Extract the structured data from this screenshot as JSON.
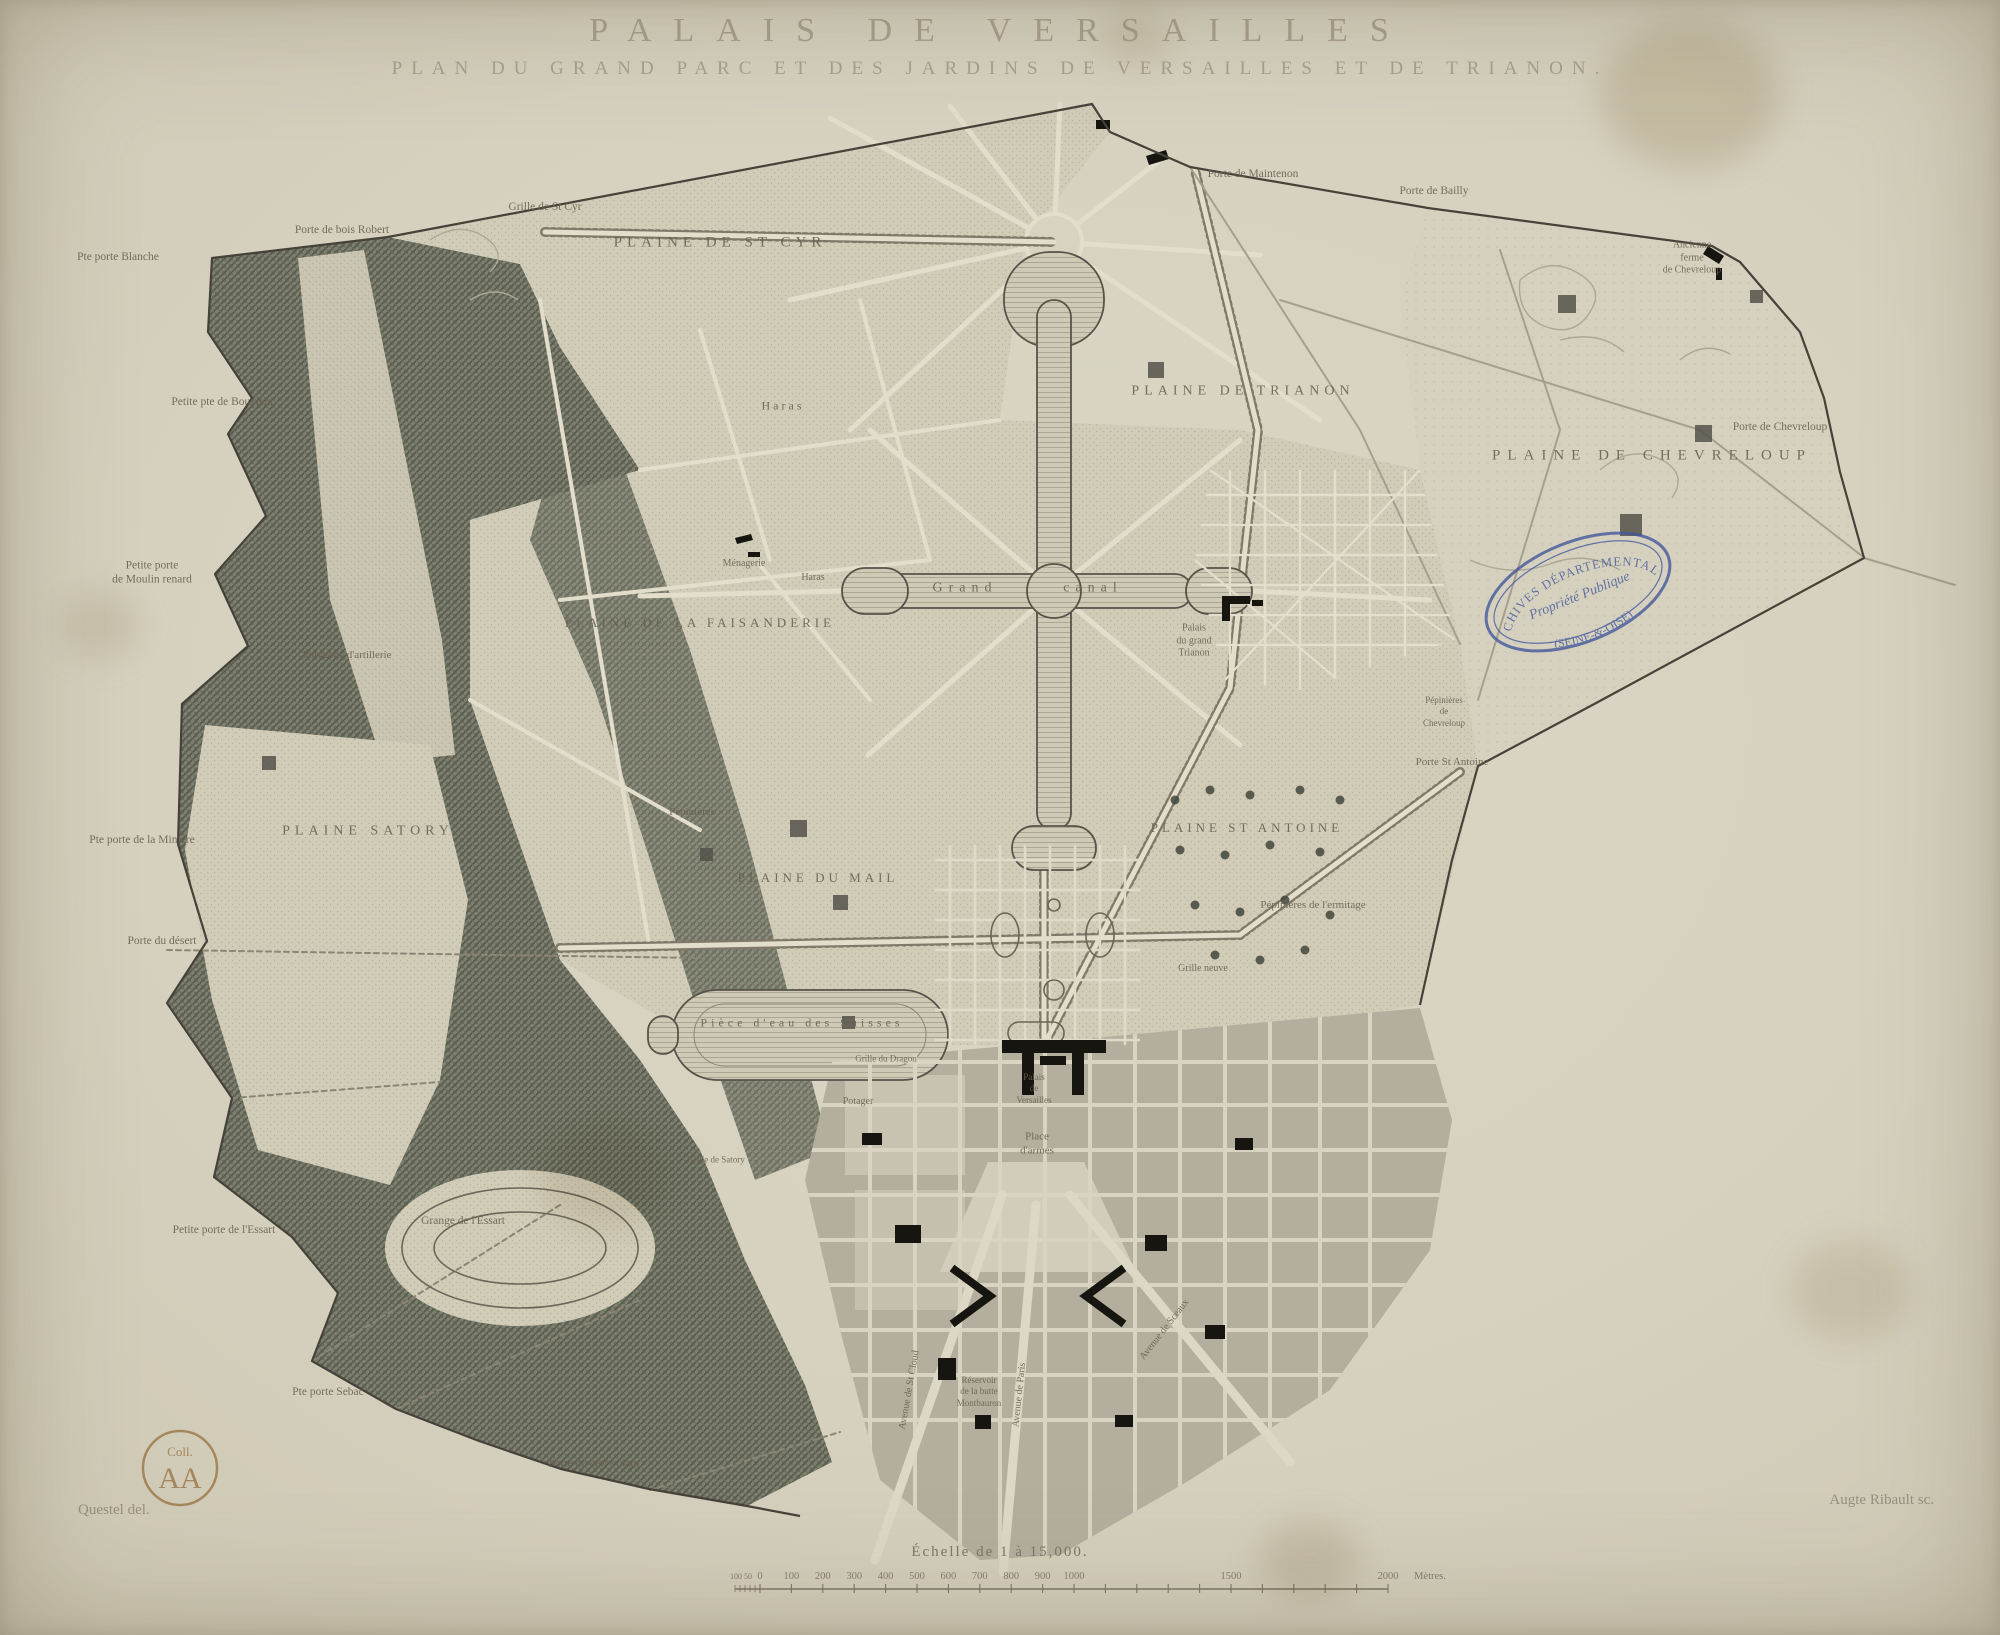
{
  "title": "PALAIS DE VERSAILLES",
  "subtitle": "PLAN DU GRAND PARC ET DES JARDINS DE VERSAILLES ET DE TRIANON.",
  "credits": {
    "left": "Questel del.",
    "right": "Augte Ribault sc."
  },
  "stamps": {
    "oval": {
      "line1": "ARCHIVES DÉPARTEMENTALES",
      "line2": "Propriété Publique",
      "line3": "(SEINE-&-OISE)",
      "color": "#44589c"
    },
    "round": {
      "line1": "Coll.",
      "line2": "AA",
      "color": "#96713f"
    }
  },
  "scale": {
    "caption": "Échelle de 1 à 15,000.",
    "unit": "Mètres.",
    "talon_labels": [
      "100",
      "50"
    ],
    "tick_values": [
      0,
      100,
      200,
      300,
      400,
      500,
      600,
      700,
      800,
      900,
      1000,
      1500,
      2000
    ]
  },
  "map": {
    "labels": [
      {
        "text": "PLAINE DE ST CYR",
        "x": 720,
        "y": 243,
        "size": 15,
        "sp": 5
      },
      {
        "text": "PLAINE DE TRIANON",
        "x": 1243,
        "y": 391,
        "size": 14,
        "sp": 5
      },
      {
        "text": "PLAINE DE CHEVRELOUP",
        "x": 1652,
        "y": 456,
        "size": 15,
        "sp": 7
      },
      {
        "text": "PLAINE SATORY",
        "x": 368,
        "y": 831,
        "size": 14,
        "sp": 5
      },
      {
        "text": "PLAINE DE LA FAISANDERIE",
        "x": 700,
        "y": 623,
        "size": 13,
        "sp": 4
      },
      {
        "text": "PLAINE DU MAIL",
        "x": 818,
        "y": 878,
        "size": 13,
        "sp": 4
      },
      {
        "text": "PLAINE ST ANTOINE",
        "x": 1247,
        "y": 828,
        "size": 13,
        "sp": 4
      },
      {
        "text": "Grille de St Cyr",
        "x": 545,
        "y": 207
      },
      {
        "text": "Porte de Maintenon",
        "x": 1253,
        "y": 174
      },
      {
        "text": "Porte de Bailly",
        "x": 1434,
        "y": 191
      },
      {
        "text": "Ancienne\nferme\nde Chevreloup",
        "x": 1692,
        "y": 258,
        "size": 10
      },
      {
        "text": "Porte de Chevreloup",
        "x": 1780,
        "y": 427
      },
      {
        "text": "Pte porte Blanche",
        "x": 118,
        "y": 257
      },
      {
        "text": "Porte de bois Robert",
        "x": 342,
        "y": 230
      },
      {
        "text": "Petite pte de Bouviers",
        "x": 222,
        "y": 402
      },
      {
        "text": "Petite porte\nde Moulin renard",
        "x": 152,
        "y": 573
      },
      {
        "text": "Pte porte de la Minière",
        "x": 142,
        "y": 840
      },
      {
        "text": "Porte du désert",
        "x": 162,
        "y": 941
      },
      {
        "text": "Petite porte de l'Essart",
        "x": 224,
        "y": 1230
      },
      {
        "text": "Grange de l'Essart",
        "x": 463,
        "y": 1221
      },
      {
        "text": "Pte porte Sebac",
        "x": 328,
        "y": 1392
      },
      {
        "text": "Porte du cerf volant",
        "x": 594,
        "y": 1464
      },
      {
        "text": "Polygone d'artillerie",
        "x": 347,
        "y": 656,
        "size": 11
      },
      {
        "text": "Haras",
        "x": 783,
        "y": 406,
        "size": 12,
        "sp": 3
      },
      {
        "text": "Ménagerie",
        "x": 744,
        "y": 564,
        "size": 10
      },
      {
        "text": "Haras",
        "x": 813,
        "y": 578,
        "size": 10
      },
      {
        "text": "Pépinières",
        "x": 692,
        "y": 813,
        "size": 11
      },
      {
        "text": "Grand",
        "x": 965,
        "y": 588,
        "size": 14,
        "sp": 6
      },
      {
        "text": "canal",
        "x": 1093,
        "y": 588,
        "size": 14,
        "sp": 6
      },
      {
        "text": "Palais\ndu grand\nTrianon",
        "x": 1194,
        "y": 641,
        "size": 10
      },
      {
        "text": "Pépinières\nde\nChevreloup",
        "x": 1444,
        "y": 712,
        "size": 9
      },
      {
        "text": "Porte St Antoine",
        "x": 1452,
        "y": 763,
        "size": 11
      },
      {
        "text": "Pépinières de l'ermitage",
        "x": 1313,
        "y": 906,
        "size": 11
      },
      {
        "text": "Grille neuve",
        "x": 1203,
        "y": 969,
        "size": 10
      },
      {
        "text": "Pièce d'eau des Suisses",
        "x": 802,
        "y": 1023,
        "size": 12,
        "sp": 4
      },
      {
        "text": "Potager",
        "x": 858,
        "y": 1102,
        "size": 10
      },
      {
        "text": "Palais\nde\nVersailles",
        "x": 1034,
        "y": 1089,
        "size": 9
      },
      {
        "text": "Place\nd'armes",
        "x": 1037,
        "y": 1144,
        "size": 11
      },
      {
        "text": "Grille du Dragon",
        "x": 886,
        "y": 1059,
        "size": 9
      },
      {
        "text": "Grille de Satory",
        "x": 716,
        "y": 1160,
        "size": 9
      },
      {
        "text": "Réservoir\nde la butte\nMontbauron",
        "x": 979,
        "y": 1392,
        "size": 9
      },
      {
        "text": "Avenue de St Cloud",
        "x": 910,
        "y": 1390,
        "size": 10,
        "rot": -80
      },
      {
        "text": "Avenue de Paris",
        "x": 1020,
        "y": 1395,
        "size": 10,
        "rot": -84
      },
      {
        "text": "Avenue de Sceaux",
        "x": 1165,
        "y": 1330,
        "size": 10,
        "rot": -52
      }
    ]
  }
}
